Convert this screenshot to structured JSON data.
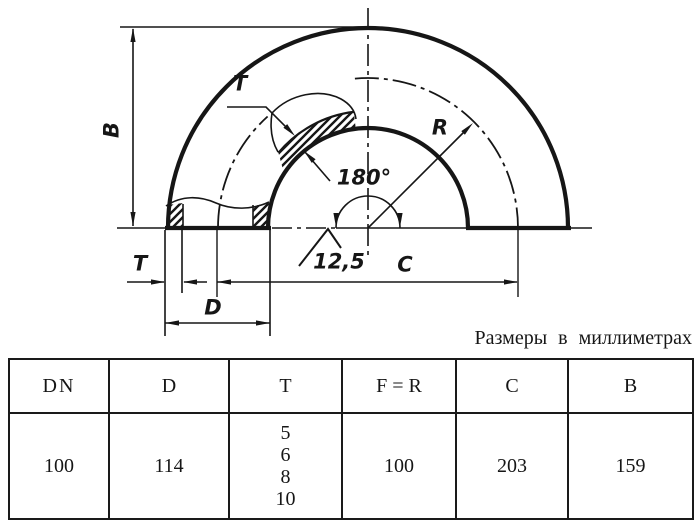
{
  "page": {
    "background": "#ffffff",
    "ink": "#161616"
  },
  "caption": "Размеры в миллиметрах",
  "drawing": {
    "labels": [
      {
        "name": "dim-label-B",
        "text": "B",
        "x": 112,
        "y": 130,
        "rotate": true
      },
      {
        "name": "wall-thickness-label-top",
        "text": "T",
        "x": 240,
        "y": 84,
        "rotate": false
      },
      {
        "name": "radius-label-R",
        "text": "R",
        "x": 440,
        "y": 128,
        "rotate": false
      },
      {
        "name": "angle-label",
        "text": "180°",
        "x": 364,
        "y": 178,
        "rotate": false
      },
      {
        "name": "roughness-value",
        "text": "12,5",
        "x": 339,
        "y": 262,
        "rotate": false
      },
      {
        "name": "dim-label-C",
        "text": "C",
        "x": 405,
        "y": 265,
        "rotate": false
      },
      {
        "name": "wall-thickness-label-bottom",
        "text": "T",
        "x": 140,
        "y": 264,
        "rotate": false
      },
      {
        "name": "dim-label-D",
        "text": "D",
        "x": 213,
        "y": 308,
        "rotate": false
      }
    ]
  },
  "table": {
    "headers": [
      "DN",
      "D",
      "T",
      "F = R",
      "C",
      "B"
    ],
    "row": {
      "dn": "100",
      "d": "114",
      "t": [
        "5",
        "6",
        "8",
        "10"
      ],
      "f_r": "100",
      "c": "203",
      "b": "159"
    }
  }
}
